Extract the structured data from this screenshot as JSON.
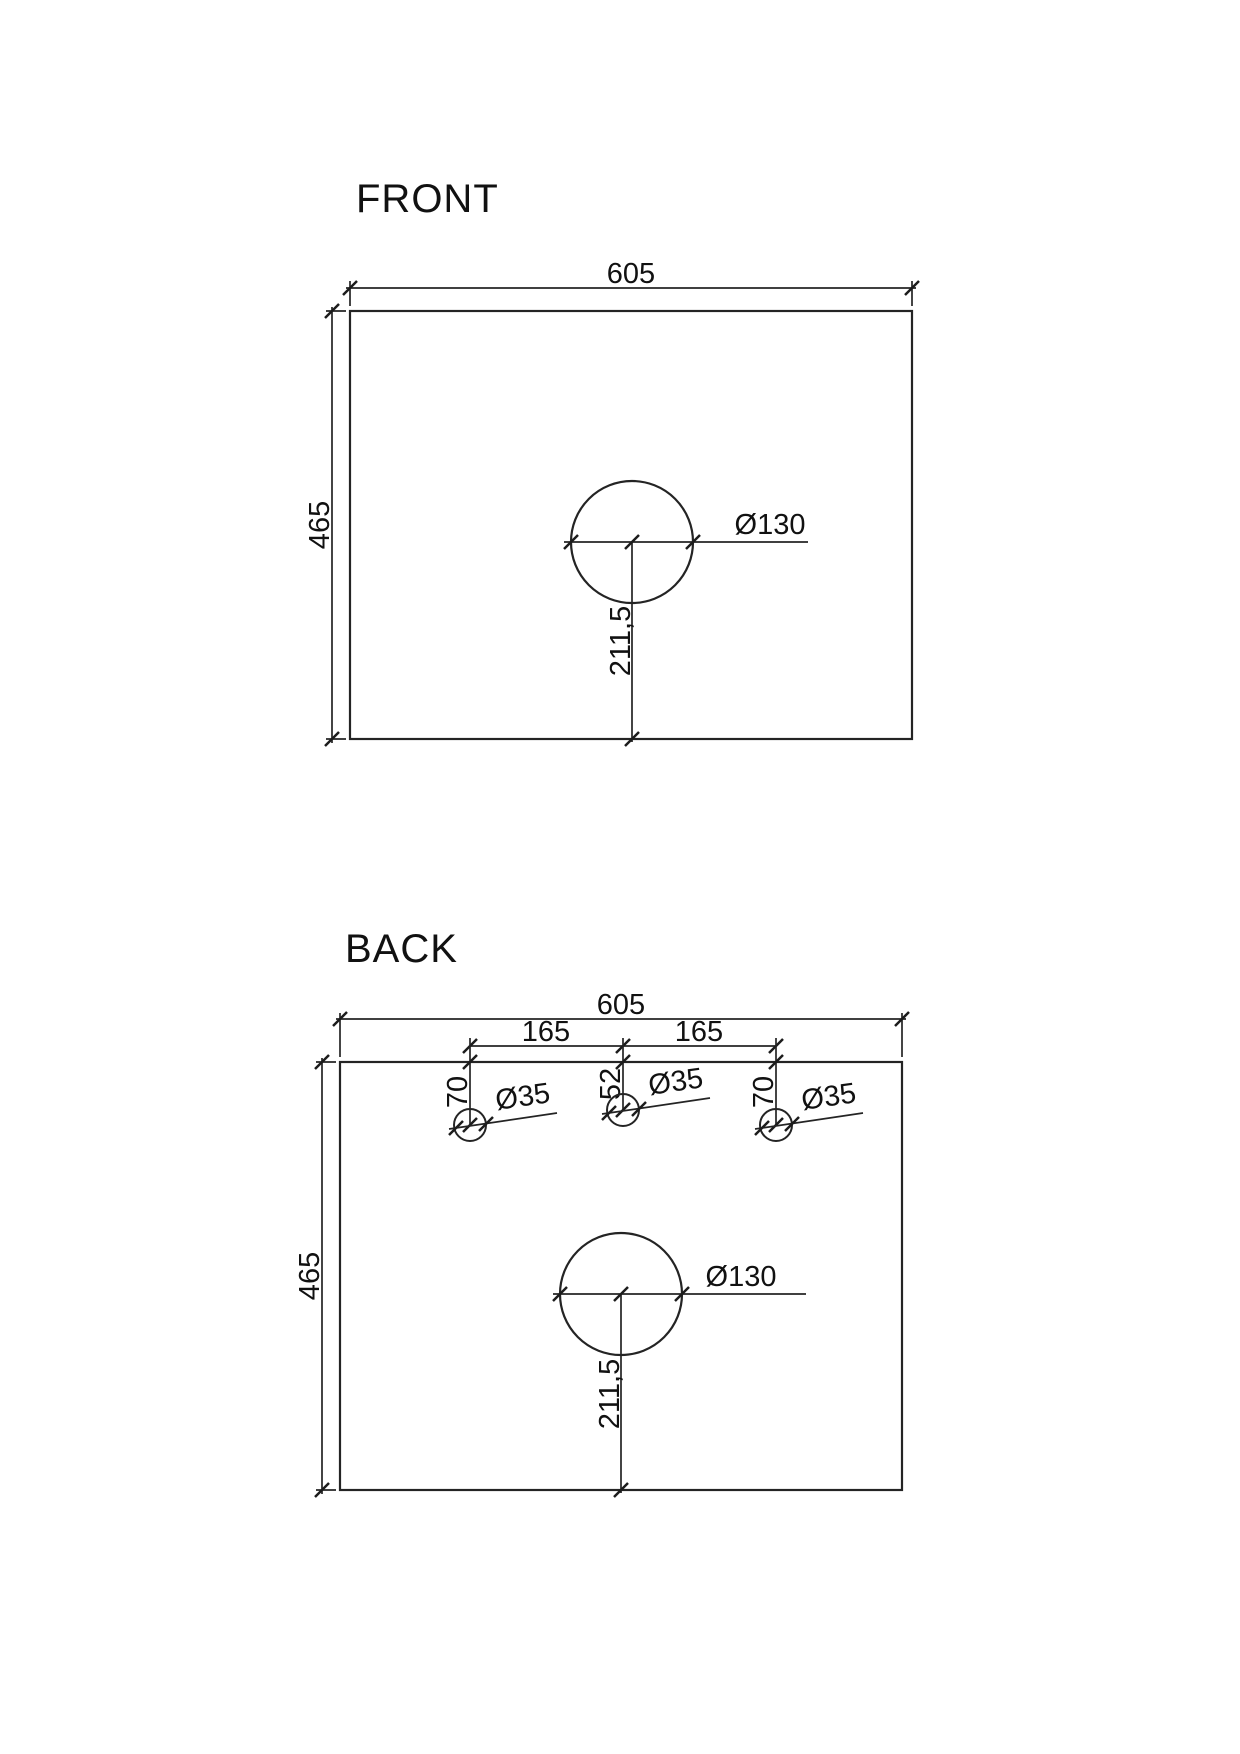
{
  "page": {
    "background": "#ffffff"
  },
  "colors": {
    "line": "#242424",
    "text": "#111111"
  },
  "front_view": {
    "title": "FRONT",
    "width": "605",
    "height": "465",
    "hole_diameter": "Ø130",
    "hole_center_from_bottom": "211,5"
  },
  "back_view": {
    "title": "BACK",
    "width": "605",
    "height": "465",
    "hole_spacing_left": "165",
    "hole_spacing_right": "165",
    "outer_hole_depth_left": "70",
    "center_hole_depth": "52",
    "outer_hole_depth_right": "70",
    "small_hole_diameter_left": "Ø35",
    "small_hole_diameter_center": "Ø35",
    "small_hole_diameter_right": "Ø35",
    "large_hole_diameter": "Ø130",
    "large_hole_center_from_bottom": "211,5"
  }
}
